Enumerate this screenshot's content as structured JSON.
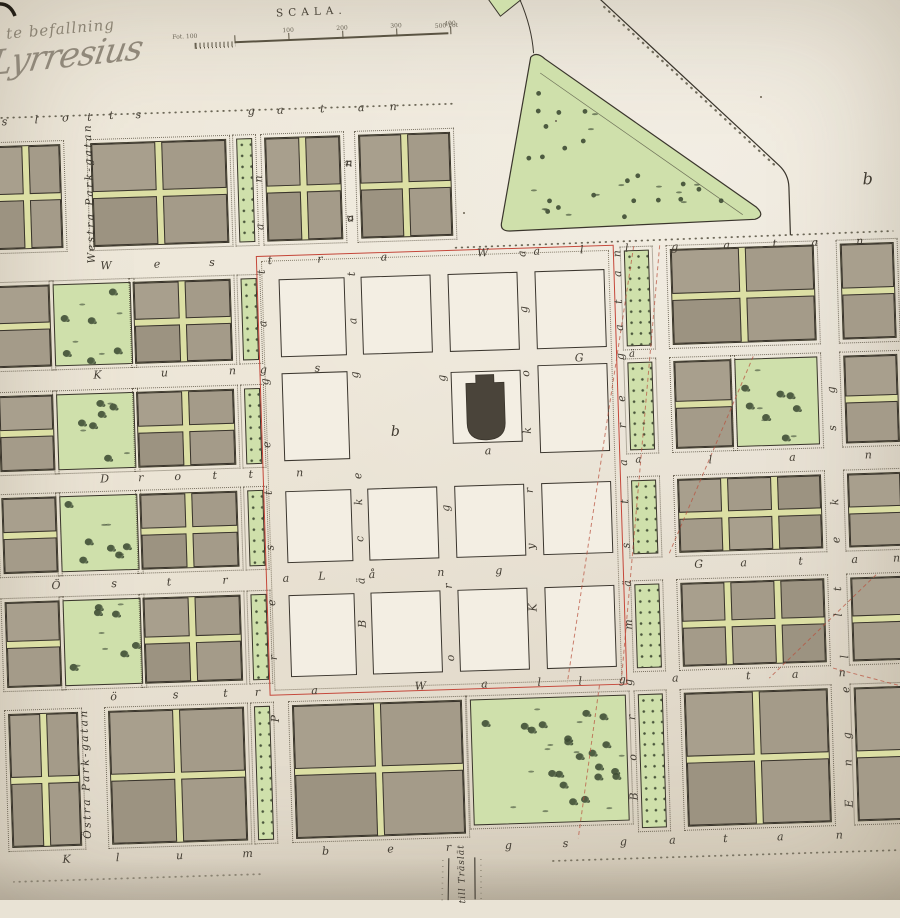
{
  "handwriting": {
    "line1": "te befallning",
    "signature": "Lyrresius"
  },
  "scale_bar": {
    "title": "SCALA.",
    "left_label": "Fot. 100",
    "tick_labels": [
      "100",
      "200",
      "300",
      "400"
    ],
    "right_label": "500 Fot"
  },
  "street_names": [
    {
      "name": "Slottsgatan",
      "orientation": "horizontal"
    },
    {
      "name": "Westra Gatan",
      "orientation": "horizontal"
    },
    {
      "name": "Wallgatan",
      "orientation": "horizontal"
    },
    {
      "name": "Kungsgatan",
      "orientation": "horizontal"
    },
    {
      "name": "Drottninggatan",
      "orientation": "horizontal"
    },
    {
      "name": "Östra Långgatan",
      "orientation": "horizontal"
    },
    {
      "name": "Klumbergsgatan",
      "orientation": "horizontal"
    },
    {
      "name": "Westra Park-gatan",
      "orientation": "vertical"
    },
    {
      "name": "Östra Park-gatan",
      "orientation": "vertical"
    },
    {
      "name": "Prestegatan",
      "orientation": "vertical"
    },
    {
      "name": "Bäckegatan",
      "orientation": "vertical"
    },
    {
      "name": "Torggatan",
      "orientation": "vertical"
    },
    {
      "name": "Kyrkogatan",
      "orientation": "vertical"
    },
    {
      "name": "Borgmästaregatan",
      "orientation": "vertical"
    },
    {
      "name": "till Träslät",
      "orientation": "road-out"
    }
  ],
  "vertical_road_labels": [
    {
      "text": "Westra Park-gatan",
      "x": 98,
      "y": 182
    },
    {
      "text": "Östra Park-gatan",
      "x": 76,
      "y": 762
    },
    {
      "text": "till Träslät",
      "x": 449,
      "y": 874
    }
  ],
  "colors": {
    "paper": "#ece5d6",
    "block_grey": "#a49b89",
    "lane_green": "#dcdfa4",
    "park_green": "#cfe0ab",
    "red_boundary": "#c5473a",
    "ink": "#3a352c"
  },
  "landmarks": [
    {
      "name": "church-building",
      "letter": "a"
    },
    {
      "name": "market-square",
      "letter": "b"
    },
    {
      "name": "triangle-park"
    },
    {
      "name": "open-field",
      "letter": "b"
    }
  ],
  "place_labels": [
    {
      "t": "b",
      "x": 876,
      "y": 192,
      "fs": 16
    },
    {
      "t": "b",
      "x": 396,
      "y": 430,
      "fs": 14
    },
    {
      "t": "a",
      "x": 488,
      "y": 452,
      "fs": 11
    },
    {
      "t": "ä",
      "x": 635,
      "y": 360,
      "fs": 10
    },
    {
      "t": "a",
      "x": 638,
      "y": 466,
      "fs": 10
    }
  ],
  "street_letters": [
    [
      "s",
      15,
      108,
      0
    ],
    [
      "l",
      47,
      107,
      0
    ],
    [
      "o",
      76,
      106,
      0
    ],
    [
      "t",
      100,
      106,
      0
    ],
    [
      "t",
      122,
      105,
      0
    ],
    [
      "s",
      149,
      105,
      0
    ],
    [
      "g",
      262,
      105,
      0
    ],
    [
      "a",
      291,
      105,
      0
    ],
    [
      "t",
      333,
      105,
      0
    ],
    [
      "a",
      372,
      105,
      0
    ],
    [
      "n",
      404,
      105,
      0
    ],
    [
      "W",
      112,
      255,
      0
    ],
    [
      "e",
      163,
      255,
      0
    ],
    [
      "s",
      218,
      255,
      0
    ],
    [
      "t",
      276,
      255,
      0
    ],
    [
      "r",
      326,
      255,
      0
    ],
    [
      "a",
      390,
      255,
      0
    ],
    [
      "W",
      489,
      254,
      0
    ],
    [
      "a",
      543,
      254,
      0
    ],
    [
      "l",
      588,
      254,
      0
    ],
    [
      "l",
      633,
      254,
      0
    ],
    [
      "g",
      681,
      254,
      0
    ],
    [
      "a",
      733,
      254,
      0
    ],
    [
      "t",
      781,
      254,
      0
    ],
    [
      "a",
      821,
      254,
      0
    ],
    [
      "n",
      866,
      254,
      0
    ],
    [
      "K",
      100,
      364,
      0
    ],
    [
      "u",
      167,
      364,
      0
    ],
    [
      "n",
      235,
      364,
      0
    ],
    [
      "g",
      266,
      364,
      0
    ],
    [
      "s",
      320,
      364,
      0
    ],
    [
      "G",
      582,
      362,
      0
    ],
    [
      "D",
      104,
      468,
      0
    ],
    [
      "r",
      140,
      468,
      0
    ],
    [
      "o",
      177,
      468,
      0
    ],
    [
      "t",
      214,
      468,
      0
    ],
    [
      "t",
      250,
      468,
      0
    ],
    [
      "n",
      299,
      468,
      0
    ],
    [
      "l",
      710,
      468,
      0
    ],
    [
      "a",
      792,
      468,
      0
    ],
    [
      "n",
      868,
      468,
      0
    ],
    [
      "Ö",
      52,
      573,
      0
    ],
    [
      "s",
      110,
      573,
      0
    ],
    [
      "t",
      165,
      573,
      0
    ],
    [
      "r",
      221,
      573,
      0
    ],
    [
      "a",
      282,
      573,
      0
    ],
    [
      "L",
      318,
      572,
      0
    ],
    [
      "å",
      368,
      572,
      0
    ],
    [
      "n",
      437,
      572,
      0
    ],
    [
      "g",
      495,
      572,
      0
    ],
    [
      "G",
      695,
      572,
      0
    ],
    [
      "a",
      740,
      572,
      0
    ],
    [
      "t",
      797,
      572,
      0
    ],
    [
      "a",
      851,
      572,
      0
    ],
    [
      "n",
      893,
      572,
      0
    ],
    [
      "ö",
      106,
      686,
      0
    ],
    [
      "s",
      168,
      686,
      0
    ],
    [
      "t",
      218,
      686,
      0
    ],
    [
      "r",
      250,
      686,
      0
    ],
    [
      "a",
      307,
      686,
      0
    ],
    [
      "W",
      413,
      685,
      0
    ],
    [
      "a",
      477,
      685,
      0
    ],
    [
      "l",
      532,
      685,
      0
    ],
    [
      "l",
      573,
      685,
      0
    ],
    [
      "g",
      615,
      685,
      0
    ],
    [
      "a",
      668,
      685,
      0
    ],
    [
      "t",
      741,
      685,
      0
    ],
    [
      "a",
      788,
      685,
      0
    ],
    [
      "n",
      835,
      685,
      0
    ],
    [
      "K",
      54,
      847,
      0
    ],
    [
      "l",
      105,
      847,
      0
    ],
    [
      "u",
      167,
      847,
      0
    ],
    [
      "m",
      235,
      847,
      0
    ],
    [
      "b",
      313,
      847,
      0
    ],
    [
      "e",
      378,
      847,
      0
    ],
    [
      "r",
      436,
      847,
      0
    ],
    [
      "g",
      496,
      847,
      0
    ],
    [
      "s",
      553,
      847,
      0
    ],
    [
      "g",
      611,
      847,
      0
    ],
    [
      "a",
      660,
      847,
      0
    ],
    [
      "t",
      713,
      847,
      0
    ],
    [
      "a",
      768,
      847,
      0
    ],
    [
      "n",
      827,
      847,
      0
    ],
    [
      "P",
      267,
      713,
      1
    ],
    [
      "r",
      267,
      652,
      1
    ],
    [
      "e",
      267,
      597,
      1
    ],
    [
      "s",
      267,
      542,
      1
    ],
    [
      "t",
      267,
      487,
      1
    ],
    [
      "e",
      267,
      439,
      1
    ],
    [
      "g",
      267,
      376,
      1
    ],
    [
      "a",
      267,
      318,
      1
    ],
    [
      "t",
      267,
      266,
      1
    ],
    [
      "a",
      267,
      221,
      1
    ],
    [
      "n",
      267,
      173,
      1
    ],
    [
      "B",
      357,
      621,
      1
    ],
    [
      "ä",
      357,
      578,
      1
    ],
    [
      "c",
      357,
      536,
      1
    ],
    [
      "k",
      357,
      499,
      1
    ],
    [
      "e",
      357,
      473,
      1
    ],
    [
      "g",
      357,
      372,
      1
    ],
    [
      "a",
      357,
      318,
      1
    ],
    [
      "t",
      357,
      271,
      1
    ],
    [
      "a",
      357,
      215,
      1
    ],
    [
      "n",
      357,
      160,
      1
    ],
    [
      "o",
      444,
      658,
      1
    ],
    [
      "r",
      444,
      586,
      1
    ],
    [
      "g",
      444,
      508,
      1
    ],
    [
      "g",
      444,
      378,
      1
    ],
    [
      "K",
      528,
      610,
      1
    ],
    [
      "y",
      528,
      549,
      1
    ],
    [
      "r",
      528,
      493,
      1
    ],
    [
      "k",
      528,
      433,
      1
    ],
    [
      "o",
      528,
      376,
      1
    ],
    [
      "g",
      528,
      312,
      1
    ],
    [
      "a",
      528,
      256,
      1
    ],
    [
      "B",
      623,
      802,
      1
    ],
    [
      "o",
      623,
      763,
      1
    ],
    [
      "r",
      623,
      723,
      1
    ],
    [
      "g",
      621,
      688,
      1
    ],
    [
      "m",
      623,
      630,
      1
    ],
    [
      "ä",
      623,
      589,
      1
    ],
    [
      "s",
      623,
      551,
      1
    ],
    [
      "t",
      623,
      507,
      1
    ],
    [
      "a",
      623,
      468,
      1
    ],
    [
      "r",
      623,
      431,
      1
    ],
    [
      "e",
      623,
      404,
      1
    ],
    [
      "g",
      623,
      362,
      1
    ],
    [
      "a",
      623,
      333,
      1
    ],
    [
      "t",
      623,
      307,
      1
    ],
    [
      "a",
      623,
      279,
      1
    ],
    [
      "n",
      623,
      259,
      1
    ],
    [
      "g",
      833,
      402,
      1
    ],
    [
      "s",
      833,
      440,
      1
    ],
    [
      "k",
      833,
      514,
      1
    ],
    [
      "e",
      833,
      552,
      1
    ],
    [
      "t",
      833,
      601,
      1
    ],
    [
      "l",
      833,
      627,
      1
    ],
    [
      "l",
      838,
      669,
      1
    ],
    [
      "e",
      838,
      702,
      1
    ],
    [
      "g",
      838,
      748,
      1
    ],
    [
      "n",
      838,
      775,
      1
    ],
    [
      "E",
      838,
      816,
      1
    ],
    [
      "n",
      358,
      160,
      0
    ],
    [
      "a",
      358,
      215,
      0
    ]
  ],
  "blocks": [
    [
      0,
      132,
      70,
      104,
      "g",
      2,
      2
    ],
    [
      100,
      132,
      136,
      104,
      "g",
      2,
      2
    ],
    [
      246,
      132,
      16,
      104,
      "s",
      0,
      0
    ],
    [
      274,
      132,
      76,
      104,
      "g",
      2,
      2
    ],
    [
      368,
      132,
      92,
      104,
      "g",
      2,
      2
    ],
    [
      0,
      272,
      55,
      82,
      "g",
      2,
      1
    ],
    [
      58,
      272,
      78,
      82,
      "p",
      0,
      0
    ],
    [
      138,
      272,
      98,
      82,
      "g",
      2,
      2
    ],
    [
      246,
      272,
      16,
      82,
      "s",
      0,
      0
    ],
    [
      0,
      382,
      55,
      76,
      "g",
      2,
      1
    ],
    [
      58,
      382,
      78,
      76,
      "p",
      0,
      0
    ],
    [
      138,
      382,
      98,
      76,
      "g",
      2,
      2
    ],
    [
      246,
      382,
      16,
      76,
      "s",
      0,
      0
    ],
    [
      0,
      484,
      55,
      76,
      "g",
      2,
      1
    ],
    [
      58,
      484,
      78,
      76,
      "p",
      0,
      0
    ],
    [
      138,
      484,
      98,
      76,
      "g",
      2,
      2
    ],
    [
      246,
      484,
      16,
      76,
      "s",
      0,
      0
    ],
    [
      0,
      588,
      55,
      86,
      "g",
      2,
      1
    ],
    [
      58,
      588,
      78,
      86,
      "p",
      0,
      0
    ],
    [
      138,
      588,
      98,
      86,
      "g",
      2,
      2
    ],
    [
      246,
      588,
      16,
      86,
      "s",
      0,
      0
    ],
    [
      0,
      700,
      70,
      134,
      "g",
      2,
      2
    ],
    [
      100,
      700,
      136,
      134,
      "g",
      2,
      2
    ],
    [
      246,
      700,
      16,
      134,
      "s",
      0,
      0
    ],
    [
      284,
      700,
      170,
      134,
      "g",
      2,
      2
    ],
    [
      462,
      700,
      156,
      126,
      "p",
      0,
      0
    ],
    [
      284,
      274,
      66,
      78,
      "w",
      0,
      0
    ],
    [
      366,
      274,
      70,
      78,
      "w",
      0,
      0
    ],
    [
      453,
      274,
      70,
      78,
      "w",
      0,
      0
    ],
    [
      540,
      274,
      70,
      78,
      "w",
      0,
      0
    ],
    [
      284,
      368,
      66,
      88,
      "w",
      0,
      0
    ],
    [
      453,
      372,
      70,
      72,
      "w",
      0,
      0
    ],
    [
      540,
      368,
      70,
      88,
      "w",
      0,
      0
    ],
    [
      284,
      486,
      66,
      72,
      "w",
      0,
      0
    ],
    [
      366,
      486,
      70,
      72,
      "w",
      0,
      0
    ],
    [
      453,
      486,
      70,
      72,
      "w",
      0,
      0
    ],
    [
      540,
      486,
      70,
      72,
      "w",
      0,
      0
    ],
    [
      284,
      590,
      66,
      82,
      "w",
      0,
      0
    ],
    [
      366,
      590,
      70,
      82,
      "w",
      0,
      0
    ],
    [
      453,
      590,
      70,
      82,
      "w",
      0,
      0
    ],
    [
      540,
      590,
      70,
      82,
      "w",
      0,
      0
    ],
    [
      630,
      256,
      25,
      96,
      "s",
      0,
      0
    ],
    [
      630,
      368,
      25,
      88,
      "s",
      0,
      0
    ],
    [
      630,
      486,
      25,
      74,
      "s",
      0,
      0
    ],
    [
      630,
      590,
      25,
      84,
      "s",
      0,
      0
    ],
    [
      630,
      700,
      25,
      134,
      "s",
      0,
      0
    ],
    [
      676,
      256,
      144,
      96,
      "g",
      2,
      2
    ],
    [
      846,
      256,
      54,
      96,
      "g",
      2,
      1
    ],
    [
      676,
      368,
      58,
      88,
      "g",
      2,
      1
    ],
    [
      737,
      368,
      83,
      88,
      "p",
      0,
      0
    ],
    [
      846,
      368,
      54,
      88,
      "g",
      2,
      1
    ],
    [
      676,
      486,
      144,
      74,
      "g",
      2,
      3
    ],
    [
      846,
      486,
      54,
      74,
      "g",
      2,
      1
    ],
    [
      676,
      590,
      144,
      84,
      "g",
      2,
      3
    ],
    [
      846,
      590,
      54,
      84,
      "g",
      2,
      1
    ],
    [
      676,
      700,
      144,
      134,
      "g",
      2,
      2
    ],
    [
      846,
      700,
      54,
      134,
      "g",
      2,
      1
    ]
  ]
}
